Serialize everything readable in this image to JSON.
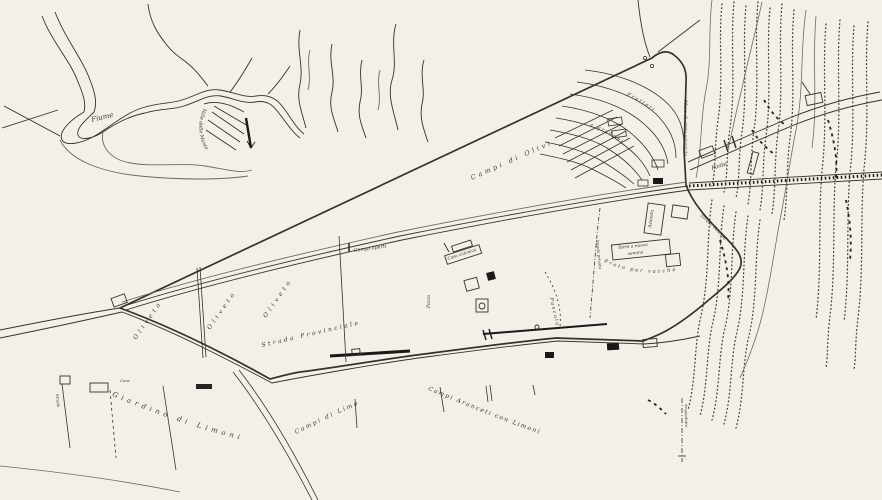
{
  "map": {
    "type": "hand-drawn estate map",
    "colors": {
      "paper": "#f2f0e9",
      "ink": "#35322b",
      "ink_dark": "#1c1a16",
      "ink_light": "#6f6a60"
    },
    "region_labels": {
      "fiume": "Fiume",
      "valle": "Valle delle Monte",
      "campi_olivi": "Campi di Olivi",
      "frutteti": "Frutteti",
      "gradoni": "a gradoni",
      "muro": "Muro di cinta orientale",
      "ponte": "Ponte",
      "strada_prov": "Strada Provinciale",
      "oliveto": "Oliveto",
      "campi_aperti": "Campi aperti",
      "casa_colonica": "Casa colonica",
      "pozzo": "Pozzo",
      "pascolo": "Pascolo",
      "azienda": "Azienda",
      "terre_line1": "Terre a nuova",
      "terre_line2": "semina",
      "prato": "Prato per vacche",
      "strada_privata": "Strada privata",
      "strada_vecchia": "Strada Vecchia",
      "giardino": "Giardino di Limoni",
      "campi_limoni": "Campi di Limoni",
      "aranceti": "Campi Aranceti con Limoni",
      "acquedotto": "Acquedotto",
      "case": "Case",
      "strada_sx": "Strada"
    }
  }
}
